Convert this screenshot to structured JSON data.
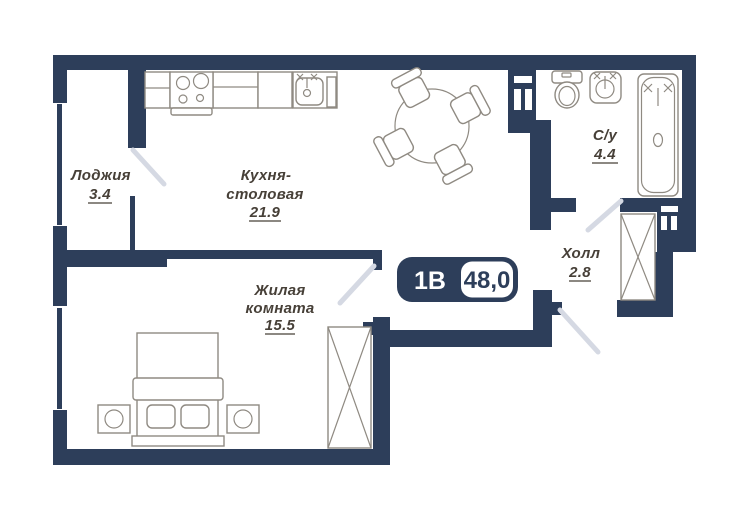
{
  "badge": {
    "type": "1В",
    "area": "48,0"
  },
  "rooms": {
    "loggia": {
      "name": "Лоджия",
      "area": "3.4"
    },
    "kitchen": {
      "name_line1": "Кухня-",
      "name_line2": "столовая",
      "area": "21.9"
    },
    "living": {
      "name_line1": "Жилая",
      "name_line2": "комната",
      "area": "15.5"
    },
    "bathroom": {
      "name": "С/у",
      "area": "4.4"
    },
    "hall": {
      "name": "Холл",
      "area": "2.8"
    }
  },
  "colors": {
    "wall": "#2d3e5a",
    "door_swing": "#d5d9e3",
    "furniture_outline": "#8f8a82",
    "label_text": "#474038",
    "background": "#ffffff"
  }
}
